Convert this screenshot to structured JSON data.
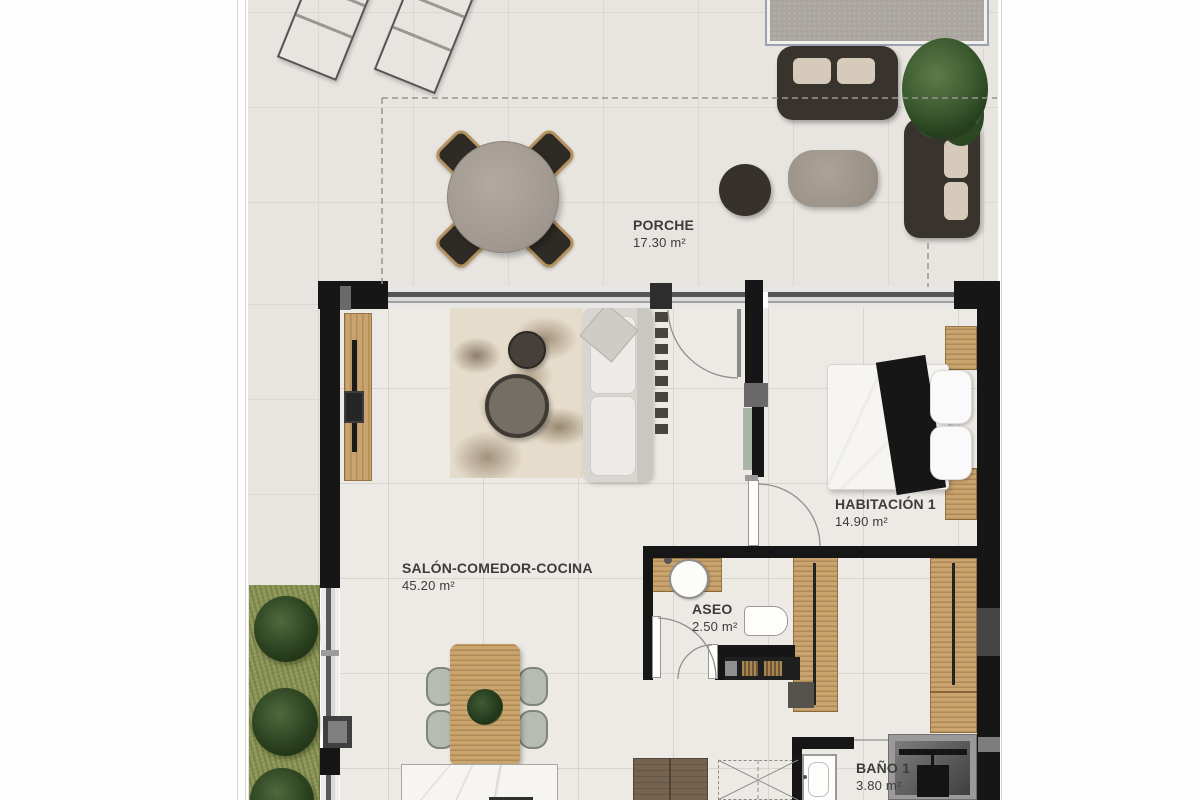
{
  "document": {
    "type": "architectural floor plan",
    "language": "es",
    "area_unit": "m²"
  },
  "rooms": [
    {
      "id": "porche",
      "name": "PORCHE",
      "area": "17.30 m²"
    },
    {
      "id": "salon-comedor-cocina",
      "name": "SALÓN-COMEDOR-COCINA",
      "area": "45.20 m²"
    },
    {
      "id": "habitacion-1",
      "name": "HABITACIÓN 1",
      "area": "14.90 m²"
    },
    {
      "id": "aseo",
      "name": "ASEO",
      "area": "2.50 m²"
    },
    {
      "id": "bano-1",
      "name": "BAÑO 1",
      "area": "3.80 m²"
    }
  ],
  "depicted_elements": [
    "sun-loungers",
    "outdoor-round-dining-table",
    "outdoor-chairs",
    "outdoor-sofa-set",
    "potted-plant",
    "coffee-table",
    "ottoman",
    "gravel-planter",
    "tv-unit",
    "area-rug",
    "round-side-tables",
    "sofa",
    "entrance-door",
    "dining-table",
    "dining-chairs",
    "kitchen-island",
    "kitchen-cabinets",
    "double-bed",
    "pillows",
    "nightstands",
    "built-in-wardrobes",
    "washbasin",
    "toilet",
    "shower",
    "interior-doors",
    "grass-strip",
    "bushes"
  ],
  "colors": {
    "wall": "#161616",
    "terrace_floor": "#e8e5e0",
    "interior_floor": "#edeae5",
    "wood": "#c9a46f",
    "grass": "#8d9656",
    "bush": "#2b4220",
    "dark_sofa": "#39332d",
    "cushion": "#d6cbbb",
    "label_text": "#3c3c3c"
  }
}
